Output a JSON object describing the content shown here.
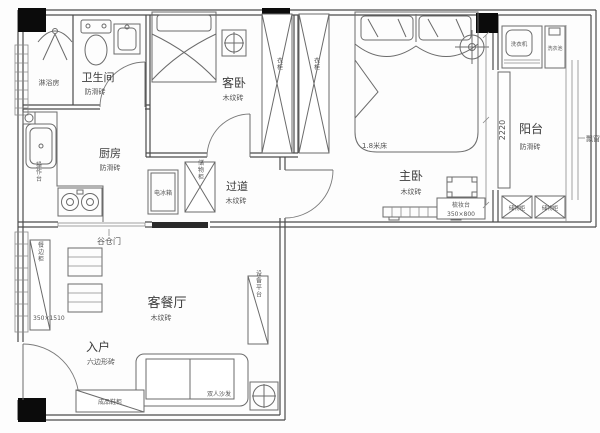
{
  "document": {
    "type": "apartment floor plan",
    "background": "#fdfdfd",
    "wall_color": "#4b4b4b",
    "text_color": "#3c3c3c"
  },
  "rooms": {
    "shower": {
      "label": "淋浴房"
    },
    "bathroom": {
      "label": "卫生间",
      "tile": "防滑砖"
    },
    "kitchen": {
      "label": "厨房",
      "tile": "防滑砖"
    },
    "guest_bedroom": {
      "label": "客卧",
      "tile": "木纹砖"
    },
    "hallway": {
      "label": "过道",
      "tile": "木纹砖"
    },
    "master_bedroom": {
      "label": "主卧",
      "tile": "木纹砖"
    },
    "balcony": {
      "label": "阳台",
      "tile": "防滑砖"
    },
    "living_dining": {
      "label": "客餐厅",
      "tile": "木纹砖"
    },
    "entry": {
      "label": "入户",
      "tile": "六边形砖"
    }
  },
  "furniture": {
    "master_bed": "1.8米床",
    "guest_wardrobe": "衣柜",
    "master_wardrobe": "衣柜",
    "fridge": "电冰箱",
    "hall_cabinet": "储物柜",
    "kitchen_counter": "操作台",
    "barn_door": "谷仓门",
    "sideboard": "餐边柜",
    "sideboard_size": "350×1510",
    "dresser": "梳妆台",
    "dresser_size": "350×800",
    "washer": "洗衣机",
    "laundry_sink": "洗衣池",
    "balcony_cabinet_1": "储物柜",
    "balcony_cabinet_2": "储物柜",
    "sofa": "双人沙发",
    "shoe_cabinet": "成品鞋柜",
    "equipment_platform": "设备平台",
    "bay_window": "飘窗"
  },
  "dimensions": {
    "balcony_depth": "2220"
  }
}
